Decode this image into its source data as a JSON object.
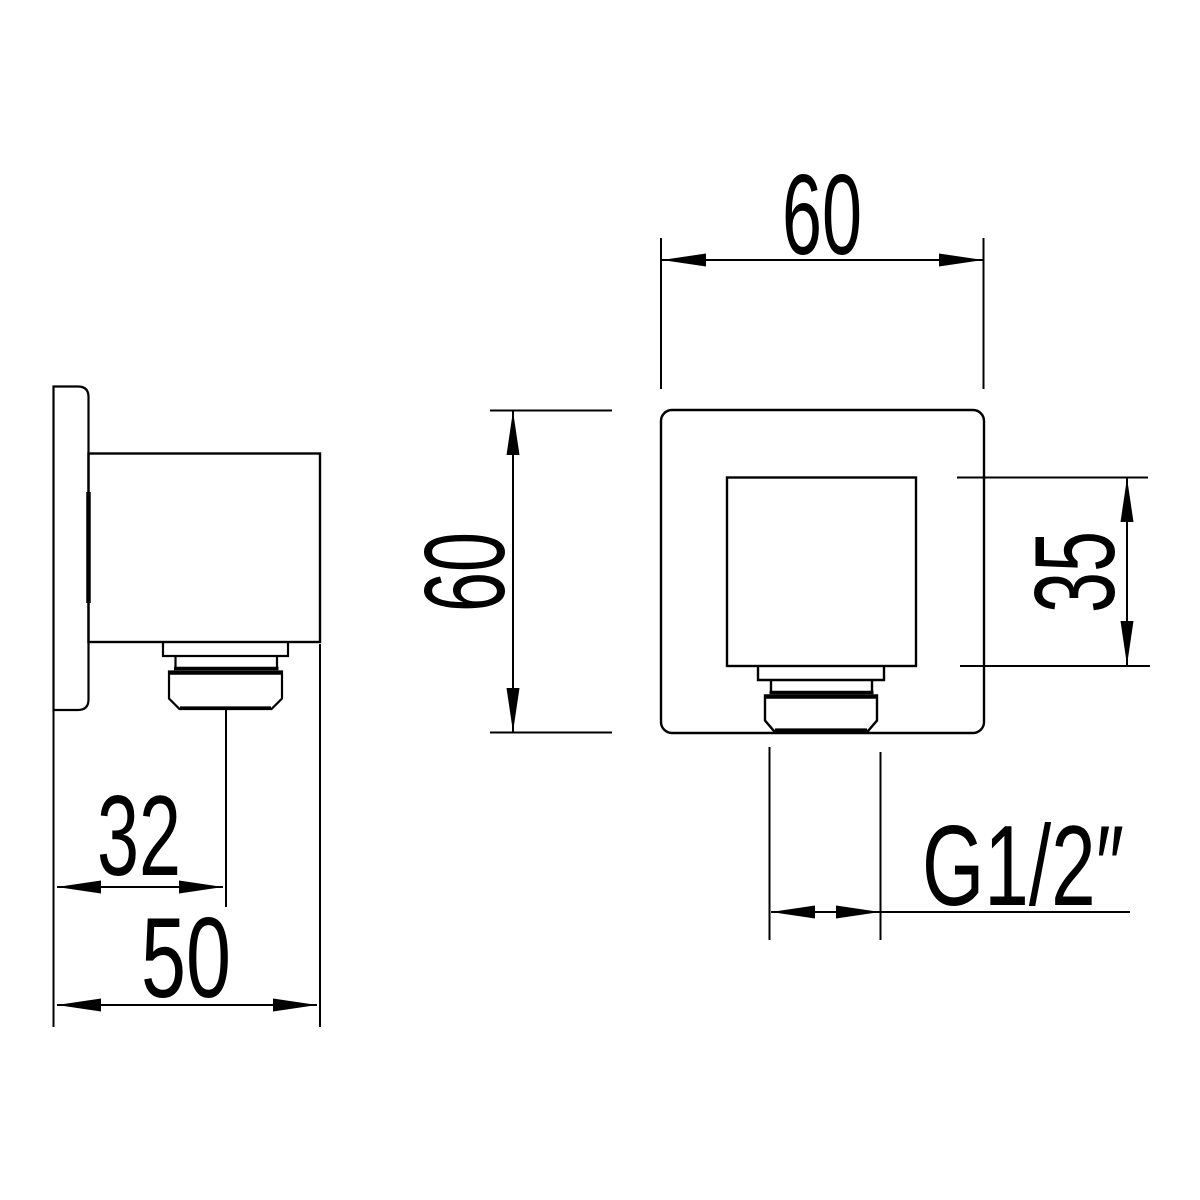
{
  "drawing": {
    "dimensions": {
      "front_width": "60",
      "front_height": "60",
      "boss_height": "35",
      "thread_size": "G1/2″",
      "outlet_offset": "32",
      "mount_depth": "50"
    },
    "colors": {
      "line": "#000000",
      "background": "#ffffff"
    }
  }
}
